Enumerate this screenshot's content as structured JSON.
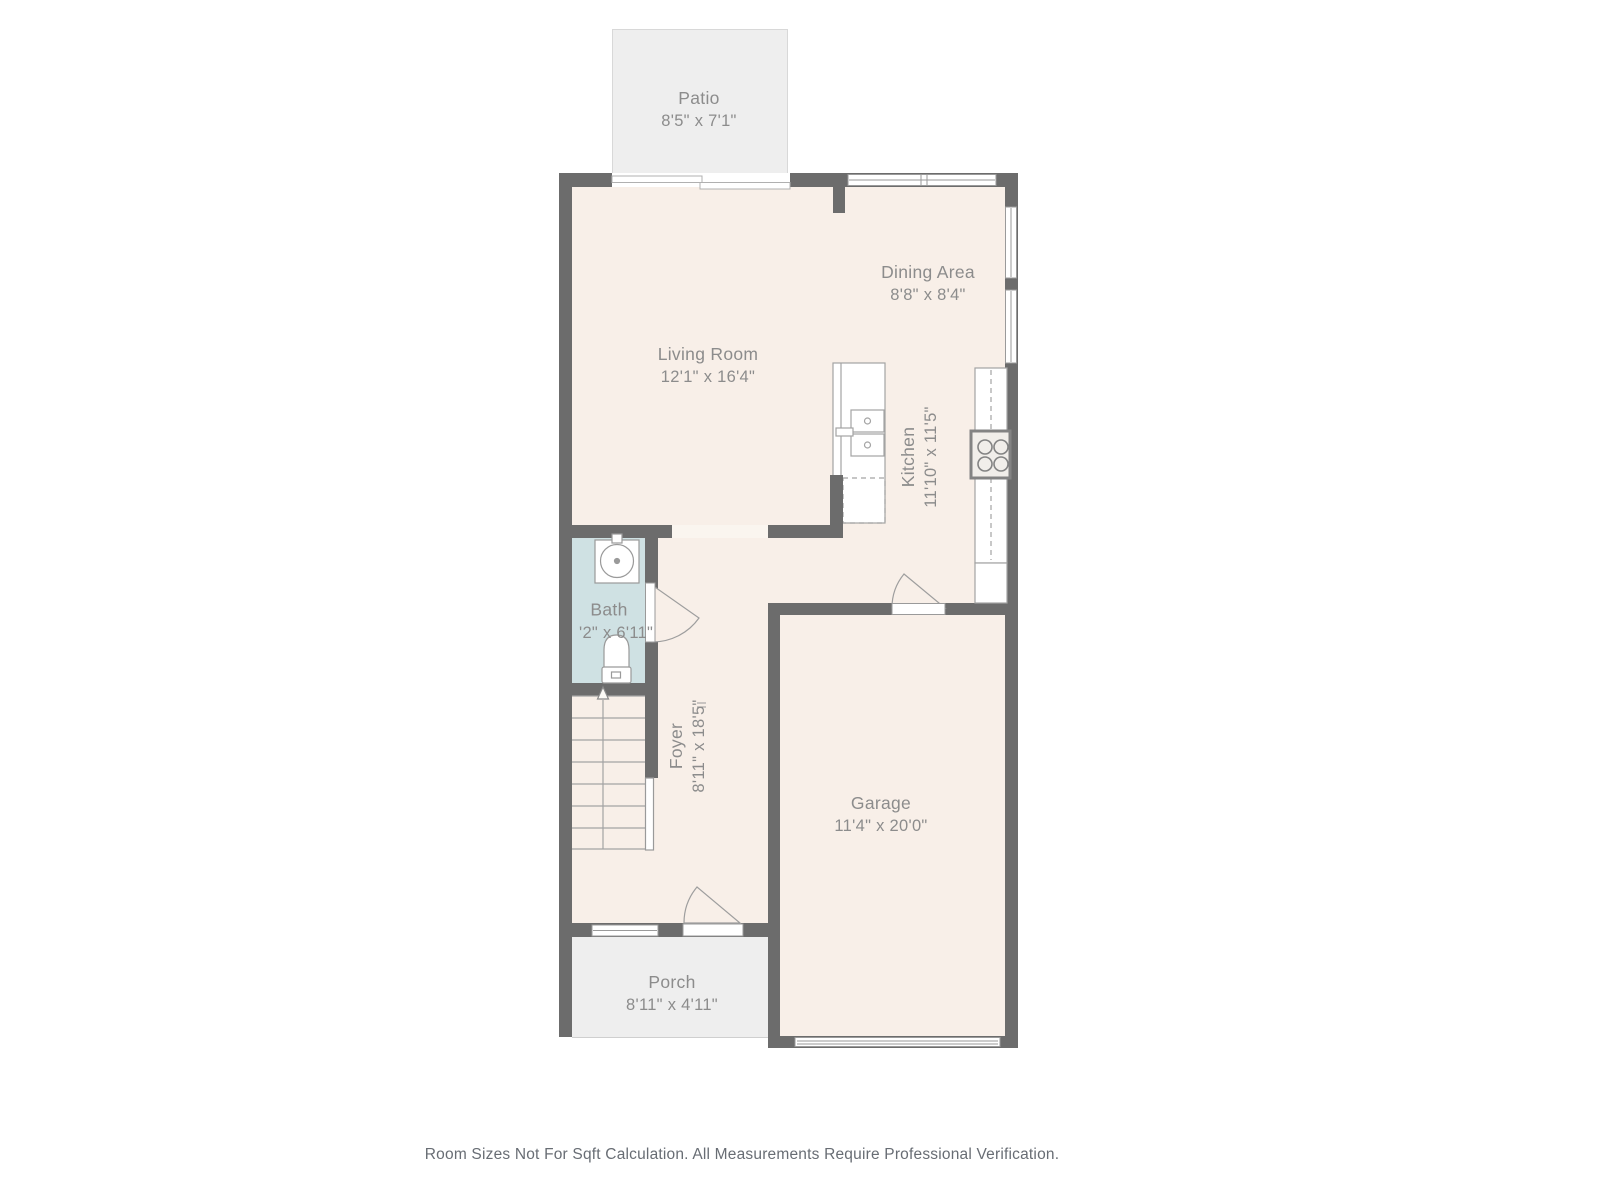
{
  "rooms": {
    "patio": {
      "name": "Patio",
      "dims": "8'5\" x 7'1\""
    },
    "living": {
      "name": "Living Room",
      "dims": "12'1\" x 16'4\""
    },
    "dining": {
      "name": "Dining Area",
      "dims": "8'8\" x 8'4\""
    },
    "kitchen": {
      "name": "Kitchen",
      "dims": "11'10\" x 11'5\""
    },
    "bath": {
      "name": "Bath",
      "dims": "'2\" x 6'11\""
    },
    "foyer": {
      "name": "Foyer",
      "dims": "8'11\" x 18'5\""
    },
    "garage": {
      "name": "Garage",
      "dims": "11'4\" x 20'0\""
    },
    "porch": {
      "name": "Porch",
      "dims": "8'11\" x 4'11\""
    }
  },
  "footer": {
    "disclaimer": "Room Sizes Not For Sqft Calculation. All Measurements Require Professional Verification."
  },
  "colors": {
    "wall": "#6c6c6c",
    "floor": "#f8efe8",
    "bath": "#cfe1e3",
    "outdoor": "#eeeeee",
    "label_text": "#8c8c8c",
    "disclaimer_text": "#686d74"
  }
}
